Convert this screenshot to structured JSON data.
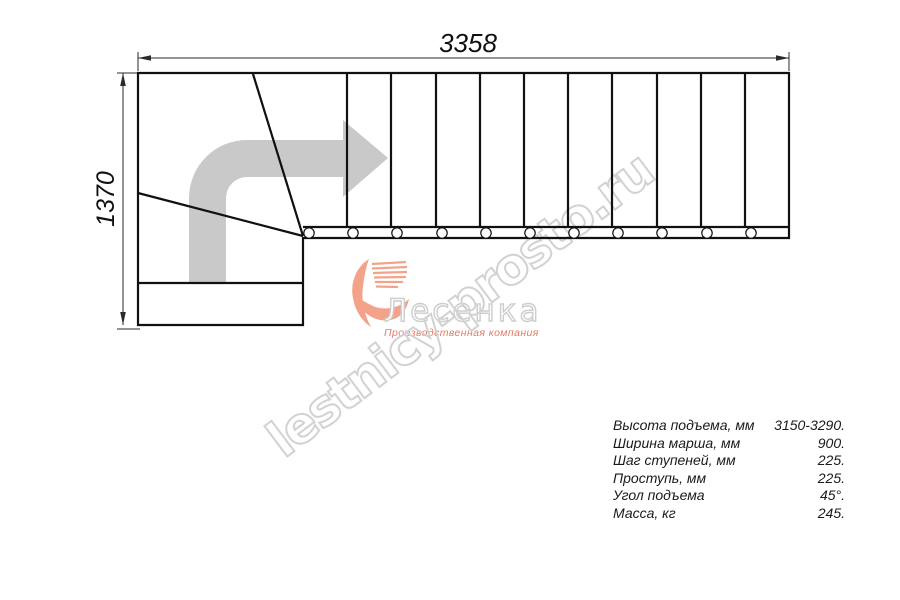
{
  "drawing": {
    "width_label": "3358",
    "height_label": "1370",
    "straight_treads_count": 11,
    "winder_steps_count": 3,
    "balusters_count": 11,
    "line_color": "#111111",
    "direction_arrow_color": "#c9c9c9"
  },
  "watermark": {
    "text": "lestnicy-prosto.ru",
    "color": "#d2d2d2"
  },
  "logo": {
    "name": "Лесенка",
    "tagline": "Производственная компания",
    "swoosh_color": "#f4a38a",
    "name_color": "#cdcdcd",
    "tagline_color": "#e87863"
  },
  "specs": {
    "rows": [
      {
        "label": "Высота подъема, мм",
        "value": "3150-3290."
      },
      {
        "label": "Ширина марша, мм",
        "value": "900."
      },
      {
        "label": "Шаг ступеней, мм",
        "value": "225."
      },
      {
        "label": "Проступь, мм",
        "value": "225."
      },
      {
        "label": "Угол подъема",
        "value": "45°."
      },
      {
        "label": "Масса, кг",
        "value": "245."
      }
    ]
  }
}
